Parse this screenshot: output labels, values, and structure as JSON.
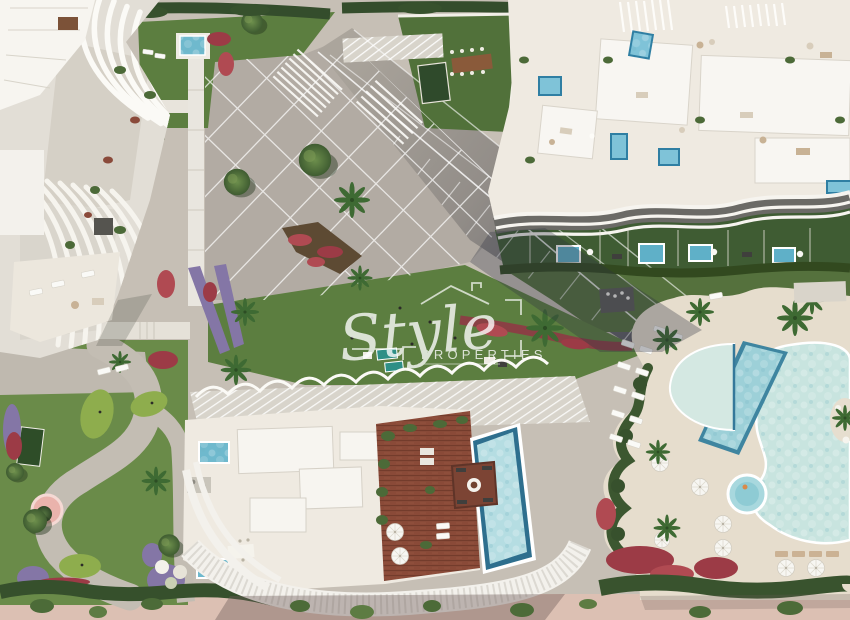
{
  "watermark": {
    "brand": "Style",
    "subtitle": "PROPERTIES",
    "color": "#ffffff"
  },
  "scene": {
    "type": "aerial-architectural-render",
    "elements": [
      "curved-balcony-apartment-building-north-west",
      "rooftop-terrace-building-north-east-with-plunge-pools",
      "penthouse-building-south-with-wood-deck-and-infinity-pool",
      "lagoon-pool-with-lap-pool-and-kids-pool",
      "paved-plaza-with-diagonal-boulevard",
      "mini-golf-garden-south-west",
      "flower-beds-red-and-lavender",
      "palm-trees",
      "beach-sand-promenade"
    ]
  },
  "palette": {
    "paving": "#c6bfb5",
    "plaza": "#b2aba3",
    "road_shadowed": "#55565e",
    "lawn": "#5c7e40",
    "minigolf_green": "#8ead4d",
    "hedge": "#37512d",
    "red_flowers": "#9c3b46",
    "lavender": "#8476a6",
    "pool_water": "#c8e4df",
    "lap_pool_rim": "#3f85a0",
    "deck_wood": "#8a4a38",
    "building_white": "#f7f5f0",
    "roof_cream": "#efeae1",
    "sand": "#dcc0b3"
  }
}
